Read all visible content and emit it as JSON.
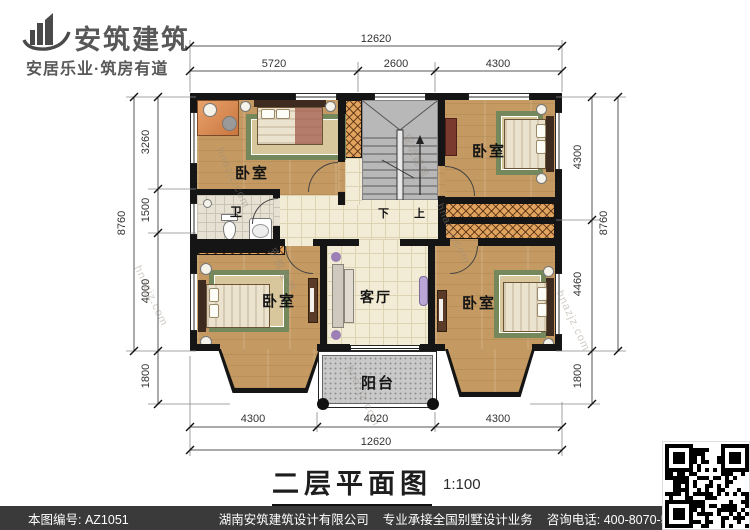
{
  "brand": {
    "name": "安筑建筑",
    "tagline": "安居乐业·筑房有道"
  },
  "plan": {
    "bedroom_tl": "卧室",
    "bedroom_tr": "卧室",
    "bedroom_bl": "卧室",
    "bedroom_br": "卧室",
    "bath": "卫",
    "living": "客厅",
    "balcony": "阳台",
    "stair_down": "下",
    "stair_up": "上"
  },
  "dimensions": {
    "top": {
      "total": "12620",
      "seg1": "5720",
      "seg2": "2600",
      "seg3": "4300"
    },
    "bottom": {
      "total": "12620",
      "seg1": "4300",
      "seg2": "4020",
      "seg3": "4300"
    },
    "left": {
      "total": "8760",
      "seg1": "3260",
      "seg2": "1500",
      "seg3": "4000",
      "seg4": "1800"
    },
    "right": {
      "total": "8760",
      "seg1": "4300",
      "seg2": "4460",
      "seg3": "1800"
    }
  },
  "caption": {
    "title": "二层平面图",
    "scale": "1:100"
  },
  "footer": {
    "drawing_no": "本图编号: AZ1051",
    "company": "湖南安筑建筑设计有限公司",
    "service": "专业承接全国别墅设计业务",
    "phone": "咨询电话: 400-8070-511",
    "web_char": "网"
  },
  "watermark": {
    "site": "hnazjz.com",
    "brand": "安筑建筑"
  },
  "colors": {
    "wall": "#151515",
    "wood": "#c49a62",
    "tile": "#f2ebd5",
    "stair": "#b8b8b8",
    "balcony": "#c9c9c9",
    "hatch": "#e2a35e",
    "footer_bg": "#3a3a3a"
  }
}
